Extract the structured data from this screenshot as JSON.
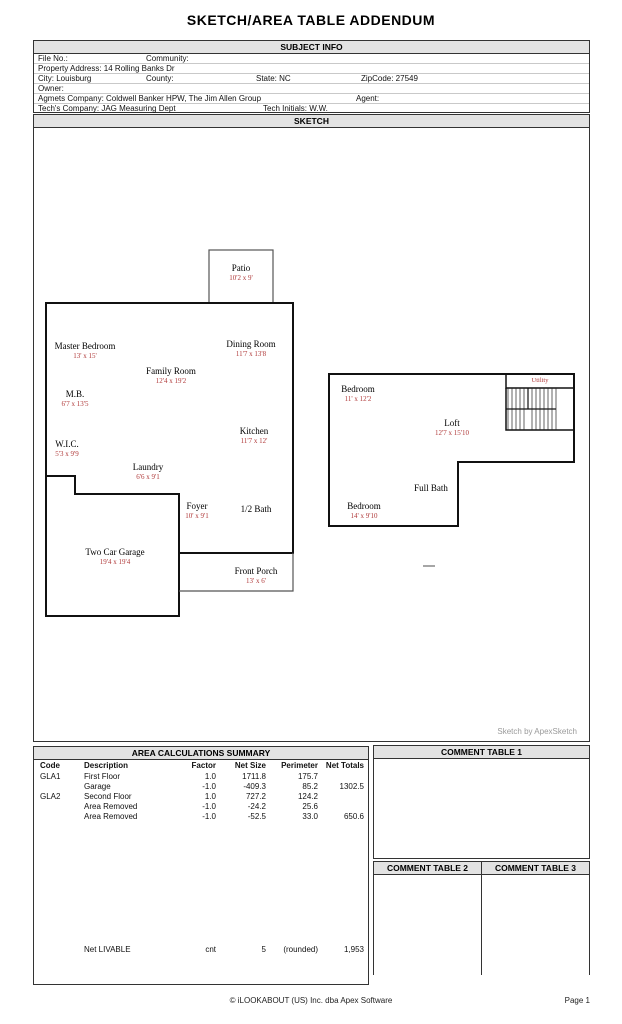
{
  "title": "SKETCH/AREA TABLE ADDENDUM",
  "subject_info": {
    "header": "SUBJECT INFO",
    "file_no": "File No.:",
    "community": "Community:",
    "property_address": "Property Address: 14 Rolling Banks Dr",
    "city": "City: Louisburg",
    "county": "County:",
    "state": "State: NC",
    "zipcode": "ZipCode: 27549",
    "owner": "Owner:",
    "agents_company": "Agmets Company: Coldwell Banker HPW, The Jim Allen Group",
    "agent": "Agent:",
    "techs_company": "Tech's Company: JAG Measuring Dept",
    "tech_initials": "Tech Initials: W.W."
  },
  "sketch": {
    "header": "SKETCH",
    "credit": "Sketch by ApexSketch",
    "rooms": {
      "patio": {
        "name": "Patio",
        "dims": "10'2 x 9'"
      },
      "master_bedroom": {
        "name": "Master Bedroom",
        "dims": "13' x 15'"
      },
      "dining_room": {
        "name": "Dining Room",
        "dims": "11'7 x 13'8"
      },
      "family_room": {
        "name": "Family Room",
        "dims": "12'4 x 19'2"
      },
      "mb": {
        "name": "M.B.",
        "dims": "6'7 x 13'5"
      },
      "kitchen": {
        "name": "Kitchen",
        "dims": "11'7 x 12'"
      },
      "wic": {
        "name": "W.I.C.",
        "dims": "5'3 x 9'9"
      },
      "laundry": {
        "name": "Laundry",
        "dims": "6'6 x 9'1"
      },
      "foyer": {
        "name": "Foyer",
        "dims": "10' x 9'1"
      },
      "half_bath": {
        "name": "1/2 Bath"
      },
      "garage": {
        "name": "Two Car Garage",
        "dims": "19'4 x 19'4"
      },
      "front_porch": {
        "name": "Front Porch",
        "dims": "13' x 6'"
      },
      "bedroom_upper": {
        "name": "Bedroom",
        "dims": "11' x 12'2"
      },
      "utility": {
        "name": "Utility"
      },
      "loft": {
        "name": "Loft",
        "dims": "12'7 x 15'10"
      },
      "full_bath": {
        "name": "Full Bath"
      },
      "bedroom_lower": {
        "name": "Bedroom",
        "dims": "14' x 9'10"
      }
    }
  },
  "area_summary": {
    "header": "AREA CALCULATIONS SUMMARY",
    "columns": [
      "Code",
      "Description",
      "Factor",
      "Net Size",
      "Perimeter",
      "Net Totals"
    ],
    "rows": [
      [
        "GLA1",
        "First Floor",
        "1.0",
        "1711.8",
        "175.7",
        ""
      ],
      [
        "",
        "Garage",
        "-1.0",
        "-409.3",
        "85.2",
        "1302.5"
      ],
      [
        "GLA2",
        "Second Floor",
        "1.0",
        "727.2",
        "124.2",
        ""
      ],
      [
        "",
        "Area Removed",
        "-1.0",
        "-24.2",
        "25.6",
        ""
      ],
      [
        "",
        "Area Removed",
        "-1.0",
        "-52.5",
        "33.0",
        "650.6"
      ]
    ],
    "net_row": [
      "",
      "Net LIVABLE",
      "cnt",
      "5",
      "(rounded)",
      "1,953"
    ]
  },
  "comment_tables": {
    "t1": "COMMENT TABLE 1",
    "t2": "COMMENT TABLE 2",
    "t3": "COMMENT TABLE 3"
  },
  "footer": {
    "copyright": "© iLOOKABOUT (US) Inc. dba Apex Software",
    "page": "Page 1"
  },
  "colors": {
    "dim_red": "#b03a3a",
    "header_bar": "#e3e3e3",
    "wall": "#111111",
    "credit_gray": "#9a9a9a"
  }
}
